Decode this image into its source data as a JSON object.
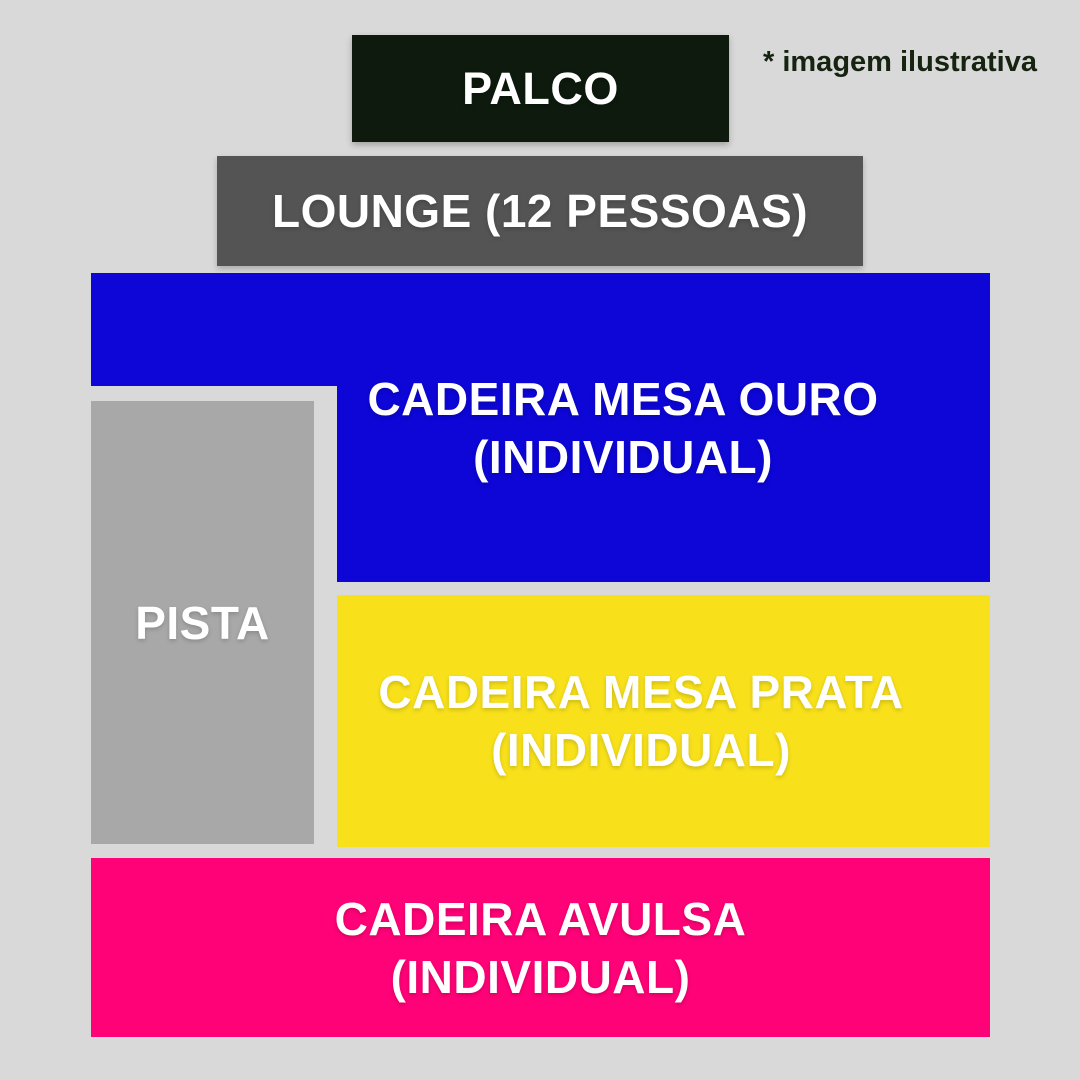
{
  "page": {
    "background_color": "#d9d9d9",
    "note": {
      "text": "* imagem ilustrativa",
      "color": "#152310"
    }
  },
  "zones": {
    "palco": {
      "label": "PALCO",
      "color": "#0d1a0d",
      "text_color": "#ffffff"
    },
    "lounge": {
      "label": "LOUNGE (12 PESSOAS)",
      "color": "#545454",
      "text_color": "#ffffff"
    },
    "cadeira_mesa_ouro": {
      "label_line1": "CADEIRA MESA OURO",
      "label_line2": "(INDIVIDUAL)",
      "color": "#0d06d6",
      "text_color": "#ffffff"
    },
    "pista": {
      "label": "PISTA",
      "color": "#a8a8a8",
      "text_color": "#ffffff"
    },
    "cadeira_mesa_prata": {
      "label_line1": "CADEIRA MESA PRATA",
      "label_line2": "(INDIVIDUAL)",
      "color": "#f8e11a",
      "text_color": "#ffffff"
    },
    "cadeira_avulsa": {
      "label_line1": "CADEIRA AVULSA",
      "label_line2": "(INDIVIDUAL)",
      "color": "#ff0277",
      "text_color": "#ffffff"
    }
  }
}
